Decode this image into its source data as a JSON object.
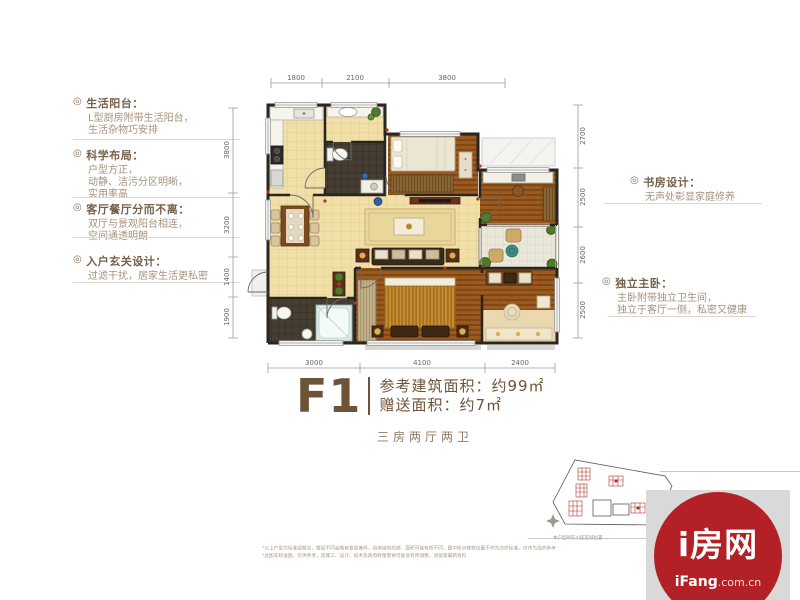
{
  "annotations_left": [
    {
      "title": "生活阳台：",
      "lines": [
        "L型厨房附带生活阳台，",
        "生活杂物巧安排"
      ]
    },
    {
      "title": "科学布局：",
      "lines": [
        "户型方正，",
        "动静、洁污分区明晰，",
        "实用率高"
      ]
    },
    {
      "title": "客厅餐厅分而不离：",
      "lines": [
        "双厅与景观阳台相连，",
        "空间通透明朗"
      ]
    },
    {
      "title": "入户玄关设计：",
      "lines": [
        "过滤干扰，居家生活更私密"
      ]
    }
  ],
  "annotations_right": [
    {
      "title": "书房设计：",
      "lines": [
        "无声处彰显家庭修养"
      ]
    },
    {
      "title": "独立主卧：",
      "lines": [
        "主卧附带独立卫生间，",
        "独立于客厅一侧，私密又健康"
      ]
    }
  ],
  "bullet_glyph": "◎",
  "dims": {
    "top": [
      "1800",
      "2100",
      "3800"
    ],
    "bottom": [
      "3000",
      "4100",
      "2400"
    ],
    "left": [
      "3800",
      "3200",
      "1400",
      "1900"
    ],
    "right": [
      "2700",
      "2500",
      "2600",
      "2500"
    ]
  },
  "unit": {
    "code": "F1",
    "area1": "参考建筑面积：约99㎡",
    "area2": "赠送面积：约7㎡",
    "rooms": "三房两厅两卫"
  },
  "minimap": {
    "caption": "本户型所在小区区域位置"
  },
  "logo": {
    "name": "i房网",
    "site_bold": "iFang",
    "site_suffix": ".com.cn"
  },
  "disclaimer": {
    "line1": "*以上户型为标准层概念，楼层不同会略有变更差异，具体结构局部、面积可能有所不同，图中所示楼栋位置不作为交房标准，仅作为选房参考",
    "line2": "*此图非标准图，仅供参考，因施工、设计、技术及政府政策需要可能会有所调整，请留意最新资料"
  },
  "colors": {
    "accent_red": "#b32025",
    "text_brown": "#6d5438",
    "wall": "#29251f"
  }
}
